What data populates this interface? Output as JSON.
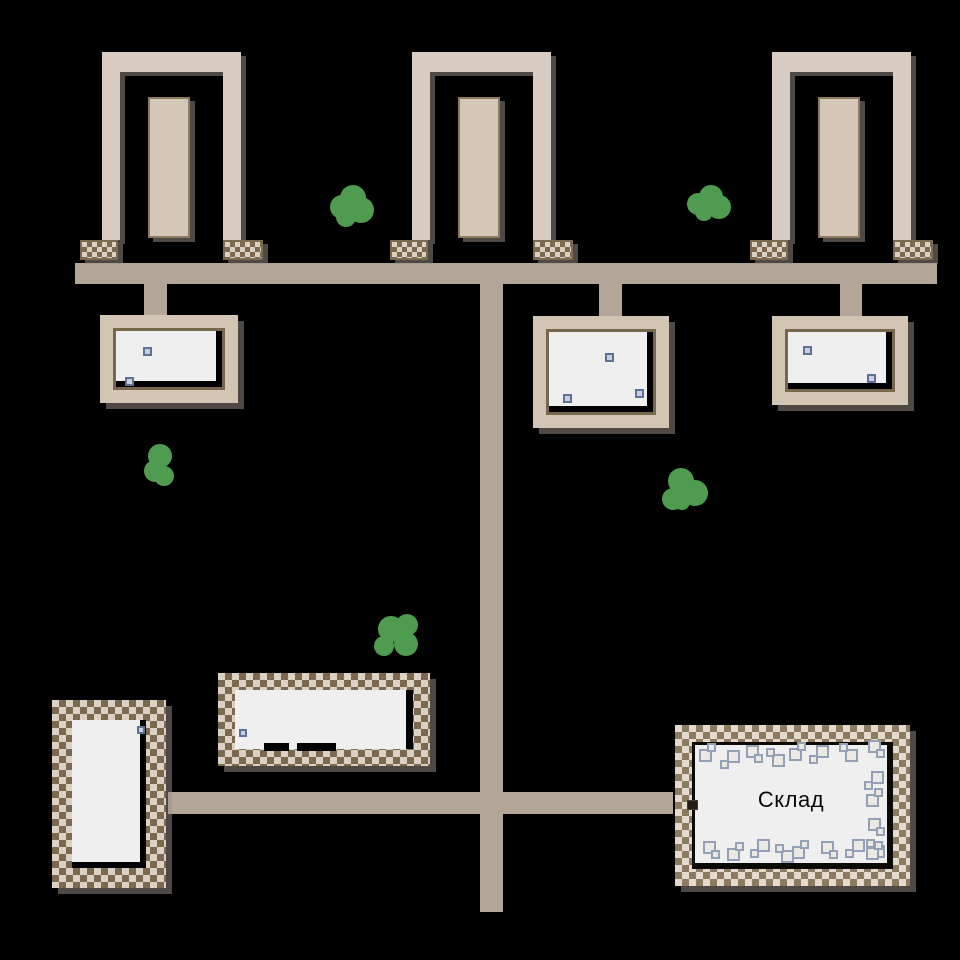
{
  "warehouse": {
    "label": "Склад"
  },
  "colors": {
    "bg": "#000000",
    "road": "#b2a698",
    "wall": "#d8ccc2",
    "wall_inner": "#d4c7b8",
    "wall_inner_border": "#8b7a5e",
    "house_frame": "#d3c5b4",
    "house_frame_border": "#77674d",
    "floor": "#efefef",
    "fence_brown": "#7b6a50",
    "fence_cream": "#dcd2c4",
    "warehouse_fence_brown": "#8b7b61",
    "warehouse_fence_cream": "#e4dbce",
    "item_fill": "#c7d0e0",
    "item_border": "#5f7198",
    "crate_fill": "#ebe9e3",
    "crate_border": "#93a0b6",
    "bush_green": "#4f9c51",
    "door": "#241c12"
  },
  "map": {
    "items": [
      {
        "x": 143,
        "y": 347,
        "s": 9
      },
      {
        "x": 125,
        "y": 377,
        "s": 9
      },
      {
        "x": 605,
        "y": 353,
        "s": 9
      },
      {
        "x": 635,
        "y": 389,
        "s": 9
      },
      {
        "x": 563,
        "y": 394,
        "s": 9
      },
      {
        "x": 803,
        "y": 346,
        "s": 9
      },
      {
        "x": 867,
        "y": 374,
        "s": 9
      },
      {
        "x": 137,
        "y": 726,
        "s": 8
      },
      {
        "x": 239,
        "y": 729,
        "s": 8
      }
    ],
    "floor_marks": [
      {
        "x": 264,
        "y": 743,
        "w": 25,
        "h": 8
      },
      {
        "x": 297,
        "y": 743,
        "w": 39,
        "h": 8
      }
    ],
    "crates": [
      {
        "x": 699,
        "y": 743,
        "v": 0
      },
      {
        "x": 720,
        "y": 750,
        "v": 1
      },
      {
        "x": 746,
        "y": 745,
        "v": 2
      },
      {
        "x": 766,
        "y": 748,
        "v": 3
      },
      {
        "x": 789,
        "y": 742,
        "v": 0
      },
      {
        "x": 809,
        "y": 745,
        "v": 1
      },
      {
        "x": 839,
        "y": 743,
        "v": 3
      },
      {
        "x": 868,
        "y": 740,
        "v": 2
      },
      {
        "x": 864,
        "y": 771,
        "v": 1
      },
      {
        "x": 866,
        "y": 788,
        "v": 0
      },
      {
        "x": 868,
        "y": 818,
        "v": 2
      },
      {
        "x": 866,
        "y": 839,
        "v": 3
      },
      {
        "x": 703,
        "y": 841,
        "v": 2
      },
      {
        "x": 727,
        "y": 842,
        "v": 0
      },
      {
        "x": 750,
        "y": 839,
        "v": 1
      },
      {
        "x": 775,
        "y": 844,
        "v": 3
      },
      {
        "x": 792,
        "y": 840,
        "v": 0
      },
      {
        "x": 821,
        "y": 841,
        "v": 2
      },
      {
        "x": 845,
        "y": 839,
        "v": 1
      },
      {
        "x": 866,
        "y": 841,
        "v": 0
      }
    ],
    "bushes": [
      {
        "x": 330,
        "y": 185,
        "lobes": [
          [
            10,
            0,
            26
          ],
          [
            0,
            10,
            24
          ],
          [
            18,
            12,
            26
          ],
          [
            6,
            22,
            20
          ]
        ]
      },
      {
        "x": 687,
        "y": 185,
        "lobes": [
          [
            12,
            0,
            24
          ],
          [
            0,
            8,
            22
          ],
          [
            20,
            10,
            24
          ],
          [
            8,
            18,
            18
          ]
        ]
      },
      {
        "x": 144,
        "y": 444,
        "lobes": [
          [
            4,
            0,
            24
          ],
          [
            0,
            16,
            22
          ],
          [
            10,
            22,
            20
          ]
        ]
      },
      {
        "x": 662,
        "y": 468,
        "lobes": [
          [
            6,
            0,
            26
          ],
          [
            0,
            20,
            22
          ],
          [
            20,
            12,
            26
          ],
          [
            12,
            26,
            16
          ]
        ]
      },
      {
        "x": 374,
        "y": 614,
        "lobes": [
          [
            4,
            2,
            26
          ],
          [
            22,
            0,
            22
          ],
          [
            20,
            18,
            24
          ],
          [
            0,
            22,
            20
          ]
        ]
      }
    ]
  }
}
